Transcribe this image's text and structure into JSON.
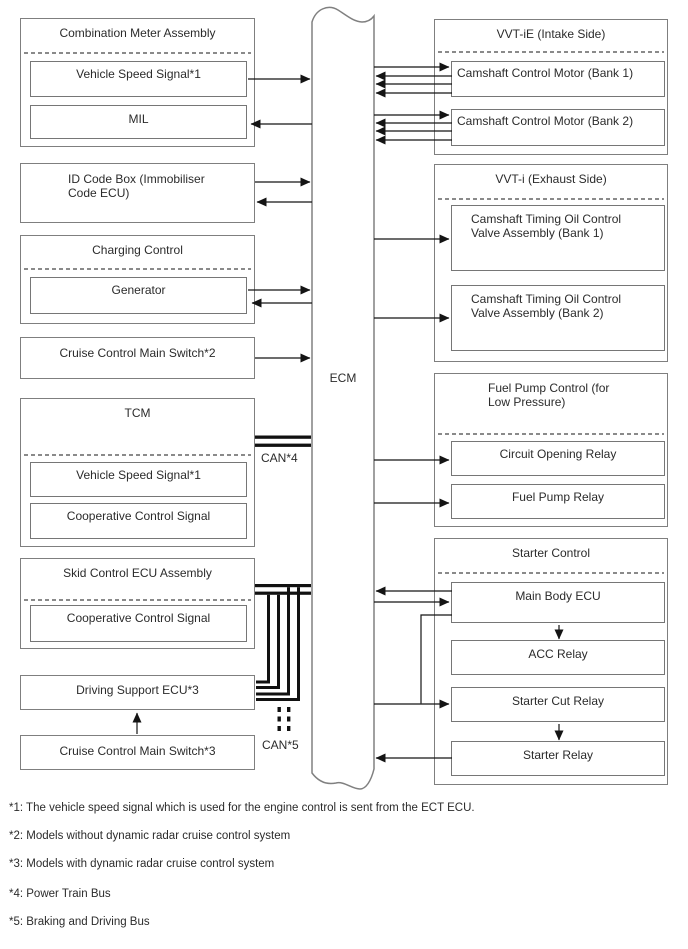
{
  "labels": {
    "ecm": "ECM",
    "can4": "CAN*4",
    "can5": "CAN*5"
  },
  "left": {
    "combination_meter": {
      "title": "Combination Meter Assembly",
      "vss": "Vehicle Speed Signal*1",
      "mil": "MIL"
    },
    "id_code": {
      "title": "ID Code Box (Immobiliser Code ECU)"
    },
    "charging": {
      "title": "Charging Control",
      "generator": "Generator"
    },
    "cruise_switch_2": {
      "title": "Cruise Control Main Switch*2"
    },
    "tcm": {
      "title": "TCM",
      "vss": "Vehicle Speed Signal*1",
      "coop": "Cooperative Control Signal"
    },
    "skid": {
      "title": "Skid Control ECU Assembly",
      "coop": "Cooperative Control Signal"
    },
    "driving_support": {
      "title": "Driving Support ECU*3"
    },
    "cruise_switch_3": {
      "title": "Cruise Control Main Switch*3"
    }
  },
  "right": {
    "vvt_ie": {
      "title": "VVT-iE (Intake Side)",
      "bank1": "Camshaft Control Motor (Bank 1)",
      "bank2": "Camshaft Control Motor (Bank 2)"
    },
    "vvt_i": {
      "title": "VVT-i (Exhaust Side)",
      "valve1": "Camshaft Timing Oil Control Valve Assembly (Bank 1)",
      "valve2": "Camshaft Timing Oil Control Valve Assembly (Bank 2)"
    },
    "fuel_pump": {
      "title": "Fuel Pump Control (for Low Pressure)",
      "circuit_opening_relay": "Circuit Opening Relay",
      "fuel_pump_relay": "Fuel Pump Relay"
    },
    "starter": {
      "title": "Starter Control",
      "main_body_ecu": "Main Body ECU",
      "acc_relay": "ACC Relay",
      "starter_cut_relay": "Starter Cut Relay",
      "starter_relay": "Starter Relay"
    }
  },
  "footnotes": [
    "*1: The vehicle speed signal which is used for the engine control is sent from the ECT ECU.",
    "*2: Models without dynamic radar cruise control system",
    "*3: Models with dynamic radar cruise control system",
    "*4: Power Train Bus",
    "*5: Braking and Driving Bus"
  ],
  "colors": {
    "background": "#ffffff",
    "box_border": "#7f7f7f",
    "line": "#141414",
    "text": "#2b2b2b"
  }
}
